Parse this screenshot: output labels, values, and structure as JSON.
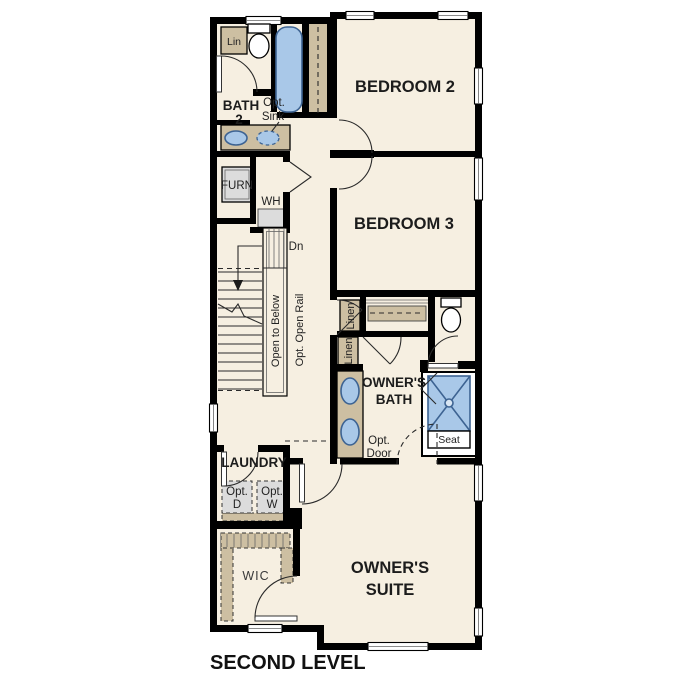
{
  "page_title": "SECOND LEVEL",
  "colors": {
    "background": "#ffffff",
    "floor": "#f6efe1",
    "walls": "#000000",
    "cabinetry_tan": "#cdbfa2",
    "appliance_gray": "#dcdcdc",
    "fixture_blue": "#a9c8e8",
    "fixture_blue_border": "#3d6392"
  },
  "rooms": {
    "bath2": [
      "BATH",
      "2"
    ],
    "bedroom2": "BEDROOM 2",
    "bedroom3": "BEDROOM 3",
    "owners_bath": [
      "OWNER'S",
      "BATH"
    ],
    "owners_suite": [
      "OWNER'S",
      "SUITE"
    ],
    "laundry": "LAUNDRY",
    "wic": "WIC"
  },
  "annotations": {
    "lin": "Lin",
    "opt_sink": [
      "Opt.",
      "Sink"
    ],
    "furn": "FURN",
    "wh": "WH",
    "dn": "Dn",
    "open_to_below": "Open to Below",
    "opt_open_rail": "Opt. Open Rail",
    "linen_upper": "Linen",
    "linen_lower": "Linen",
    "seat": "Seat",
    "opt_door": [
      "Opt.",
      "Door"
    ],
    "opt_dryer": [
      "Opt.",
      "D"
    ],
    "opt_washer": [
      "Opt.",
      "W"
    ]
  }
}
